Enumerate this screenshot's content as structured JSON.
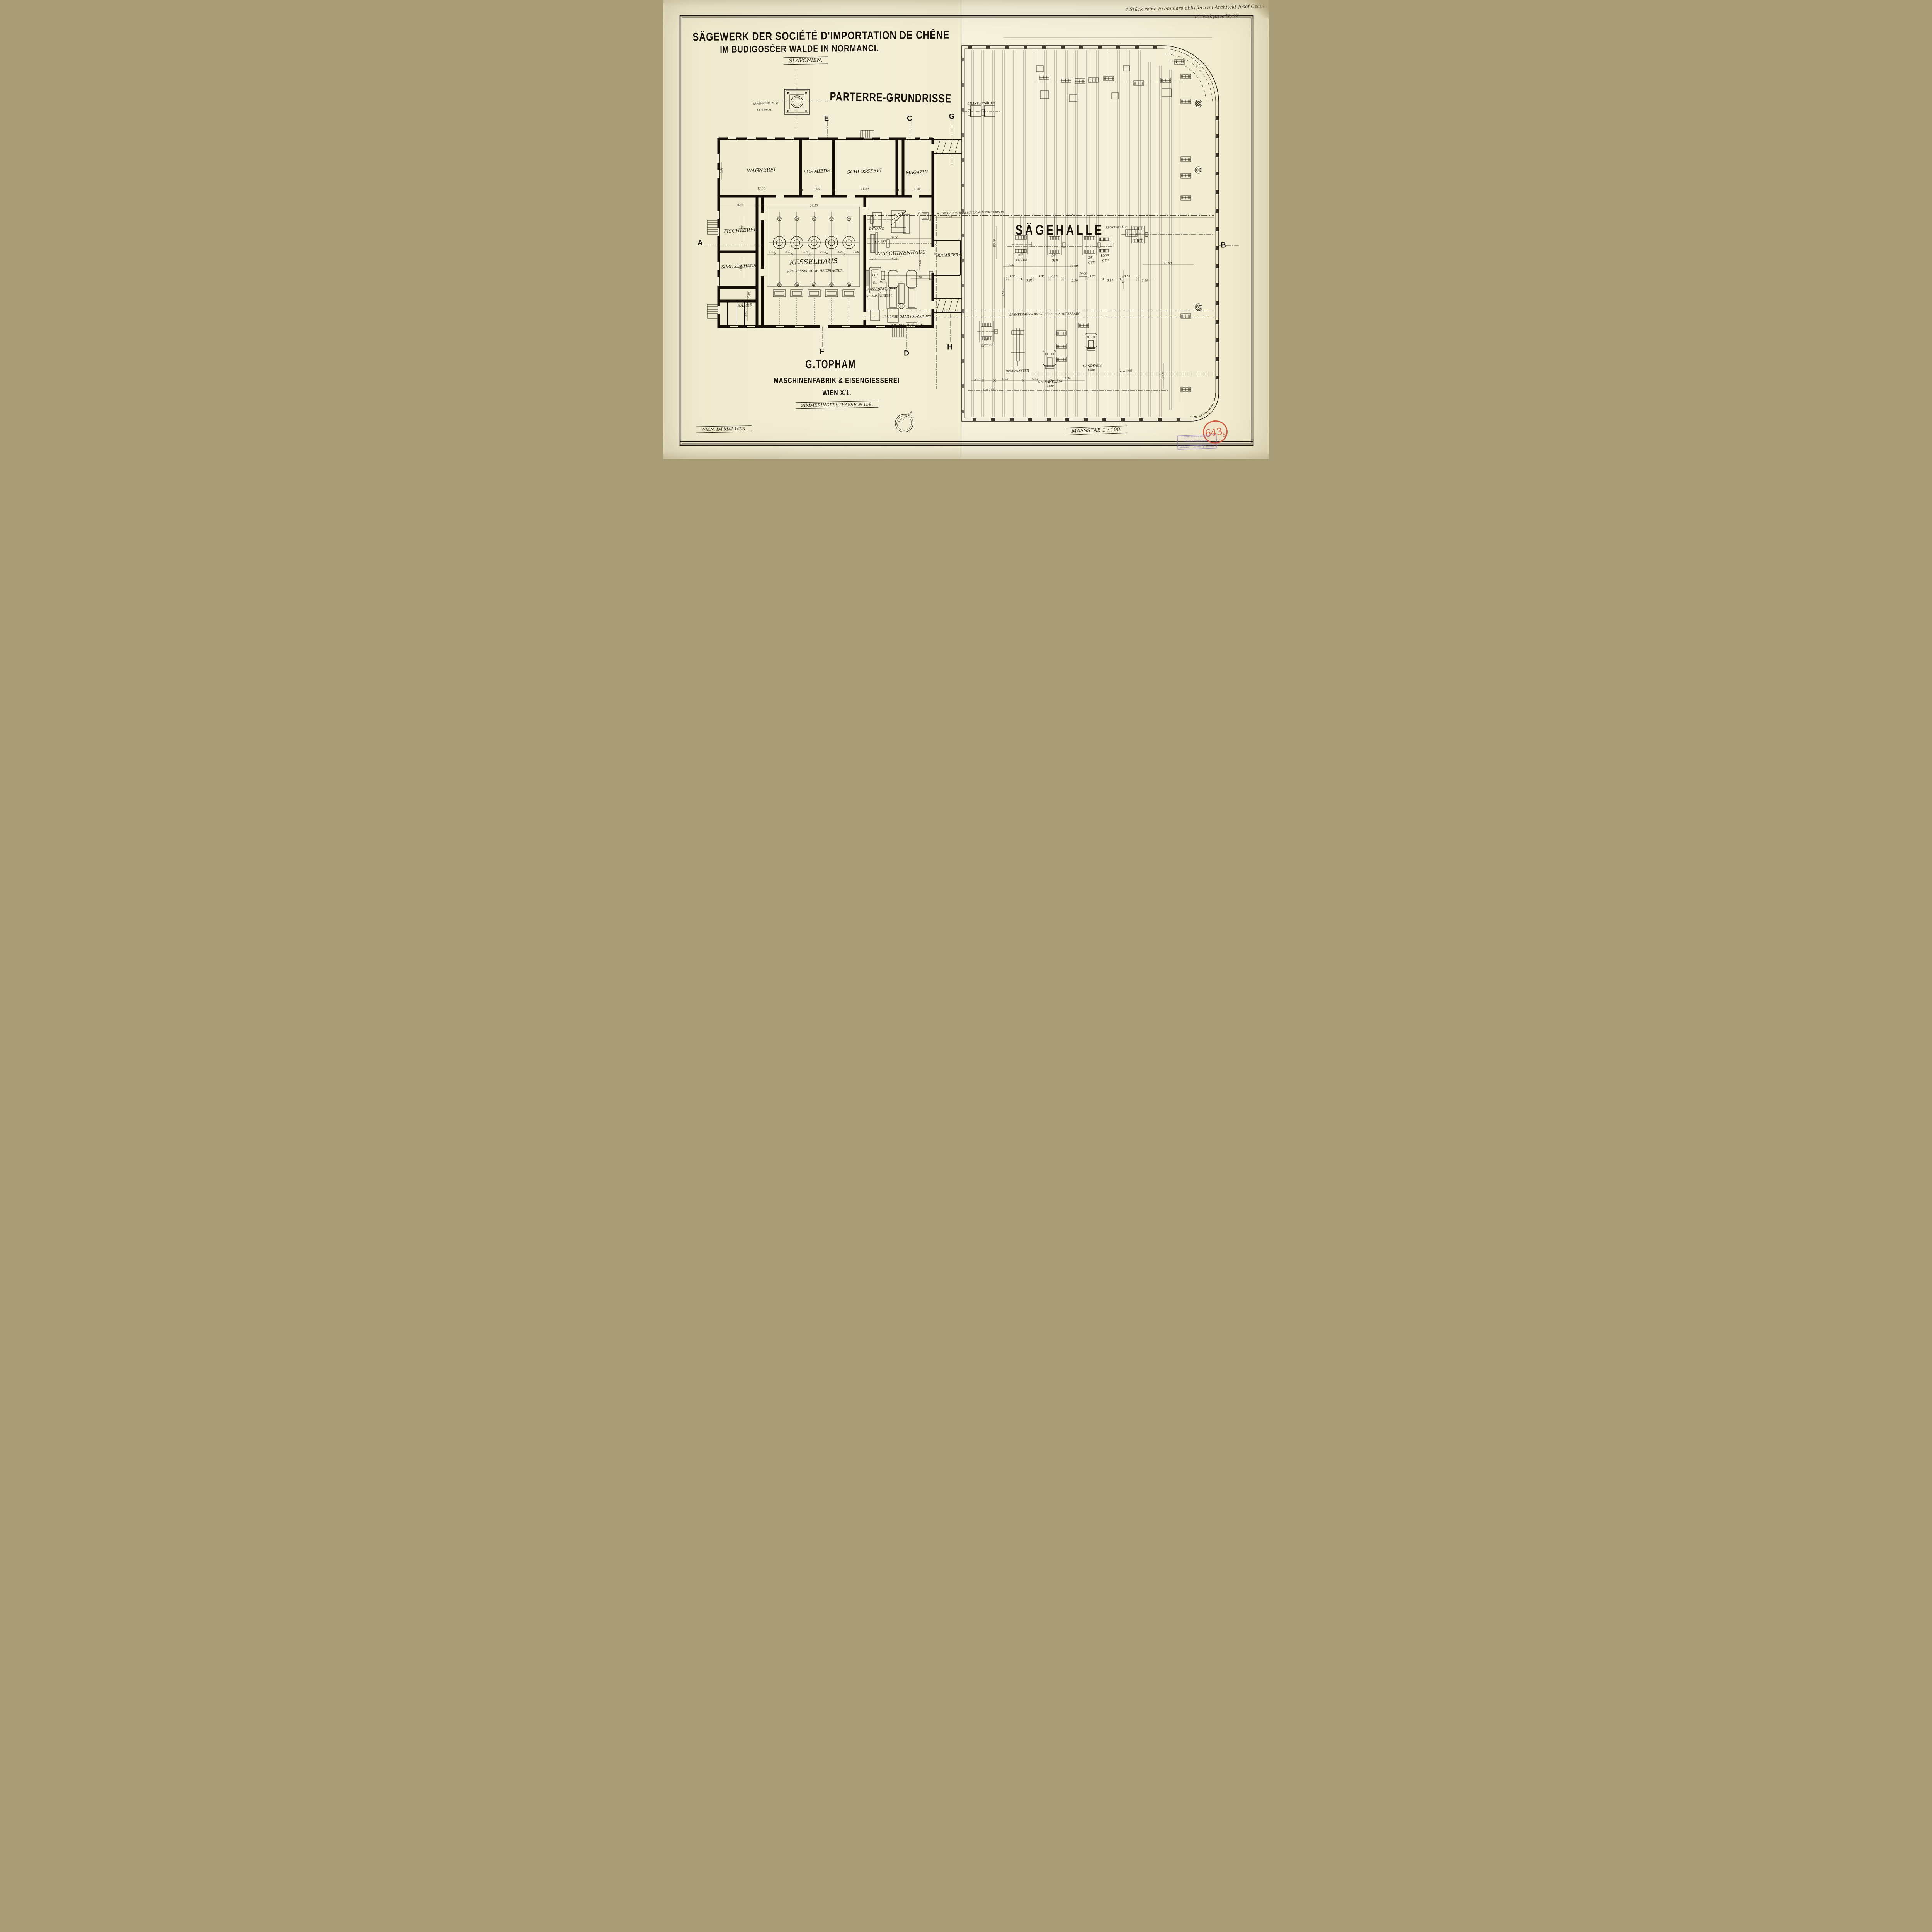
{
  "note": {
    "l1": "4 Stück reine Exemplare abliefern an Architekt Josef Czapka",
    "l2": "III. Parkgasse No 10"
  },
  "title": {
    "l1": "SÄGEWERK DER SOCIÉTÉ D'IMPORTATION DE CHÊNE",
    "l2": "IM BUDIGOSĆER WALDE IN NORMANCI.",
    "l3": "SLAVONIEN.",
    "heading": "PARTERRE-GRUNDRISSE"
  },
  "chimney": {
    "l1": "KAMINHÖHE 25 M.",
    "l2": "1300 DIAM."
  },
  "axes": {
    "a": "A",
    "b": "B",
    "c": "C",
    "d": "D",
    "e": "E",
    "f": "F",
    "g": "G",
    "h": "H"
  },
  "rooms": {
    "wagnerei": "WAGNEREI",
    "schmiede": "SCHMIEDE",
    "schlosserei": "SCHLOSSEREI",
    "magazin": "MAGAZIN",
    "tischlerei": "TISCHLEREI",
    "spritzenhaus": "SPRITZENHAUS",
    "baeder": "BÄDER",
    "kesselhaus": "KESSELHAUS",
    "kessel_note": "PRO KESSEL 60 M² HEIZFLÄCHE.",
    "maschinenhaus": "MASCHINENHAUS",
    "dynamo": "DYNAMO",
    "schaerferei": "SCHÄRFEREI"
  },
  "halle": "SÄGEHALLE",
  "machines": {
    "kleine1": "KLEINE",
    "kleine2": "DAMPFMASCHINE",
    "kleine3": "CIL.450. HUB 950",
    "grosse1": "GROSSE DAMPFMASCHINE",
    "grosse2": "CIL.475. HUB 850.",
    "cilindersaegen": "CILINDERSÄGEN",
    "pfostensaege": "PFOSTENSÄGE",
    "inch36": "36\"",
    "inch30": "30\"",
    "inch24": "24\"",
    "inch15_30": "15/30",
    "inch18": "18\"",
    "inch42": "42\"",
    "gatter": "GATTER",
    "gtr": "GTR",
    "spaltgatter": "SPALTGATTER",
    "gr_bandsaege": "GR. BANDSÄGE",
    "v2200": "2200",
    "bandsaege": "BANDSÄGE",
    "v1800": "1800"
  },
  "trans": {
    "haupt": "n : 180 HAUPTTRANSMISSION IM SOUTERRAIN",
    "spaene": "SPÄNETRANSPORTGELEISE IM SOUTERRAIN",
    "n290": "n = 290",
    "n170": "n = 170",
    "n190": "n = 190"
  },
  "dims": {
    "d13_00": "13.00",
    "d4_95": "4.95",
    "d11_00": "11.00",
    "d4_00": "4.00",
    "d9_50": "9.50",
    "d6_45": "6.45",
    "d16_20": "16.20",
    "d8_90": "8.90",
    "d1_60": "1.60",
    "d2_75": "2.75",
    "d2_30": "2.30",
    "d1_20": "1.20",
    "d2_50": "2.50",
    "d10_00": "10.00",
    "d2_10": "2.10",
    "d4_20": "4.20",
    "d8_00": "8.00",
    "d3_70": "3.70",
    "d1_80": "1.80",
    "d19_50": "19.50",
    "d5_00": "5.00",
    "d39_10": "39.10",
    "d59_10": "59.10",
    "d28_50": "28.50",
    "d14_00": "14.00",
    "d40_00": "40.00",
    "d9_00": "9.00",
    "d3_60": "3.60",
    "d5_60": "5.60",
    "d6_10": "6.10",
    "d5_20": "5.20",
    "d3_80": "3.80",
    "d3_50": "3.50",
    "d12_00": "12.00",
    "d3_00": "3.00",
    "d6_00": "6.00",
    "d7_30": "7.30"
  },
  "footer": {
    "company1": "G.TOPHAM",
    "company2": "MASCHINENFABRIK & EISENGIESSEREI",
    "company3": "WIEN X/1.",
    "company4": "SIMMERINGERSTRASSE № 159.",
    "date": "WIEN, IM MAI 1896.",
    "scale": "MASSSTAB 1 : 100.",
    "brunnen": "BRUNNEN"
  },
  "stamps": {
    "red_num": "643",
    "red_sub": "S",
    "purple1": "Technické muzeum v Brně",
    "purple2": "Sbírka výkresů a plánů",
    "purple3": "signatura",
    "purple4": "přír. čís.",
    "purple5": "8460/44"
  }
}
